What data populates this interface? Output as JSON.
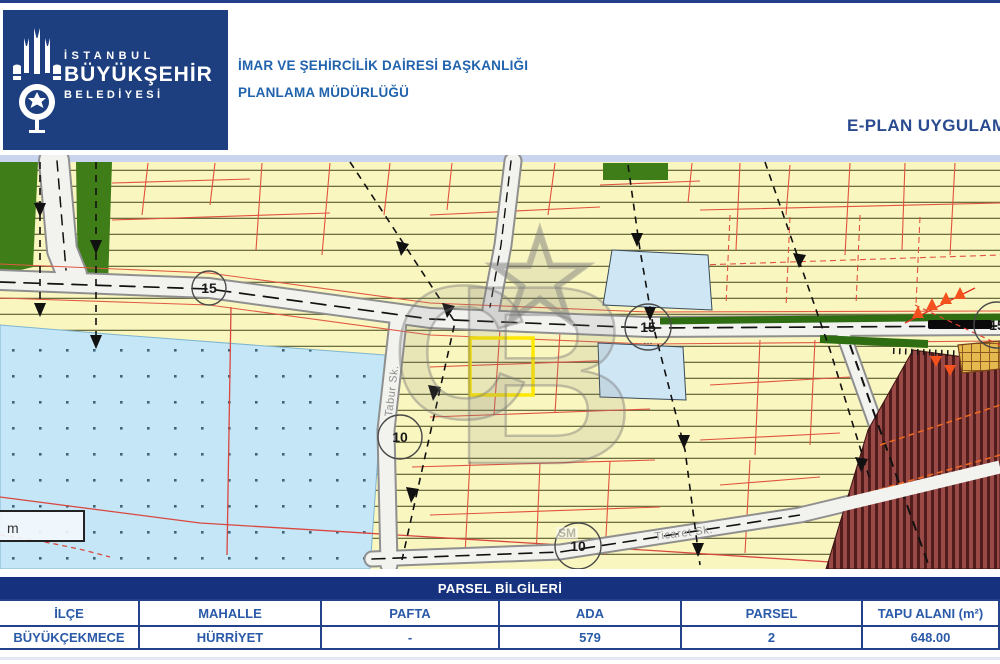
{
  "header": {
    "agency_line1": "İSTANBUL",
    "agency_line2": "BÜYÜKŞEHİR",
    "agency_line3": "BELEDİYESİ",
    "department_line1": "İMAR VE ŞEHİRCİLİK DAİRESİ BAŞKANLIĞI",
    "department_line2": "PLANLAMA MÜDÜRLÜĞÜ",
    "app_title": "E-PLAN UYGULAM"
  },
  "map": {
    "scale_label": "m",
    "watermark": {
      "star": "★",
      "letter_c": "C",
      "letter_b": "B",
      "small_text": "SM"
    },
    "road_labels": [
      {
        "text": "Tabur Sk.",
        "x": 392,
        "y": 262,
        "rotate": -83
      },
      {
        "text": "Ticaret Sk.",
        "x": 655,
        "y": 385,
        "rotate": -7
      }
    ],
    "markers": [
      {
        "label": "15",
        "x": 209,
        "y": 133,
        "r": 17
      },
      {
        "label": "15",
        "x": 648,
        "y": 172,
        "r": 23,
        "sub": "..."
      },
      {
        "label": "10",
        "x": 400,
        "y": 282,
        "r": 22
      },
      {
        "label": "10",
        "x": 578,
        "y": 391,
        "r": 23
      },
      {
        "label": "15",
        "x": 997,
        "y": 170,
        "r": 23
      }
    ]
  },
  "table": {
    "title": "PARSEL BİLGİLERİ",
    "columns": [
      "İLÇE",
      "MAHALLE",
      "PAFTA",
      "ADA",
      "PARSEL",
      "TAPU ALANI (m²)"
    ],
    "row": [
      "BÜYÜKÇEKMECE",
      "HÜRRİYET",
      "-",
      "579",
      "2",
      "648.00"
    ]
  },
  "colors": {
    "navy": "#1e3f7f",
    "table_bar": "#16327e",
    "header_text_blue": "#2263ae",
    "parcel_yellow": "#faf6bf",
    "parcel_line_red": "#e0523f",
    "lake_blue": "#c4e6f7",
    "green_area": "#3e7d18",
    "restricted_maroon": "#9a4a46",
    "highlight_yellow": "#ffe800",
    "marker_orange": "#f4511e"
  }
}
